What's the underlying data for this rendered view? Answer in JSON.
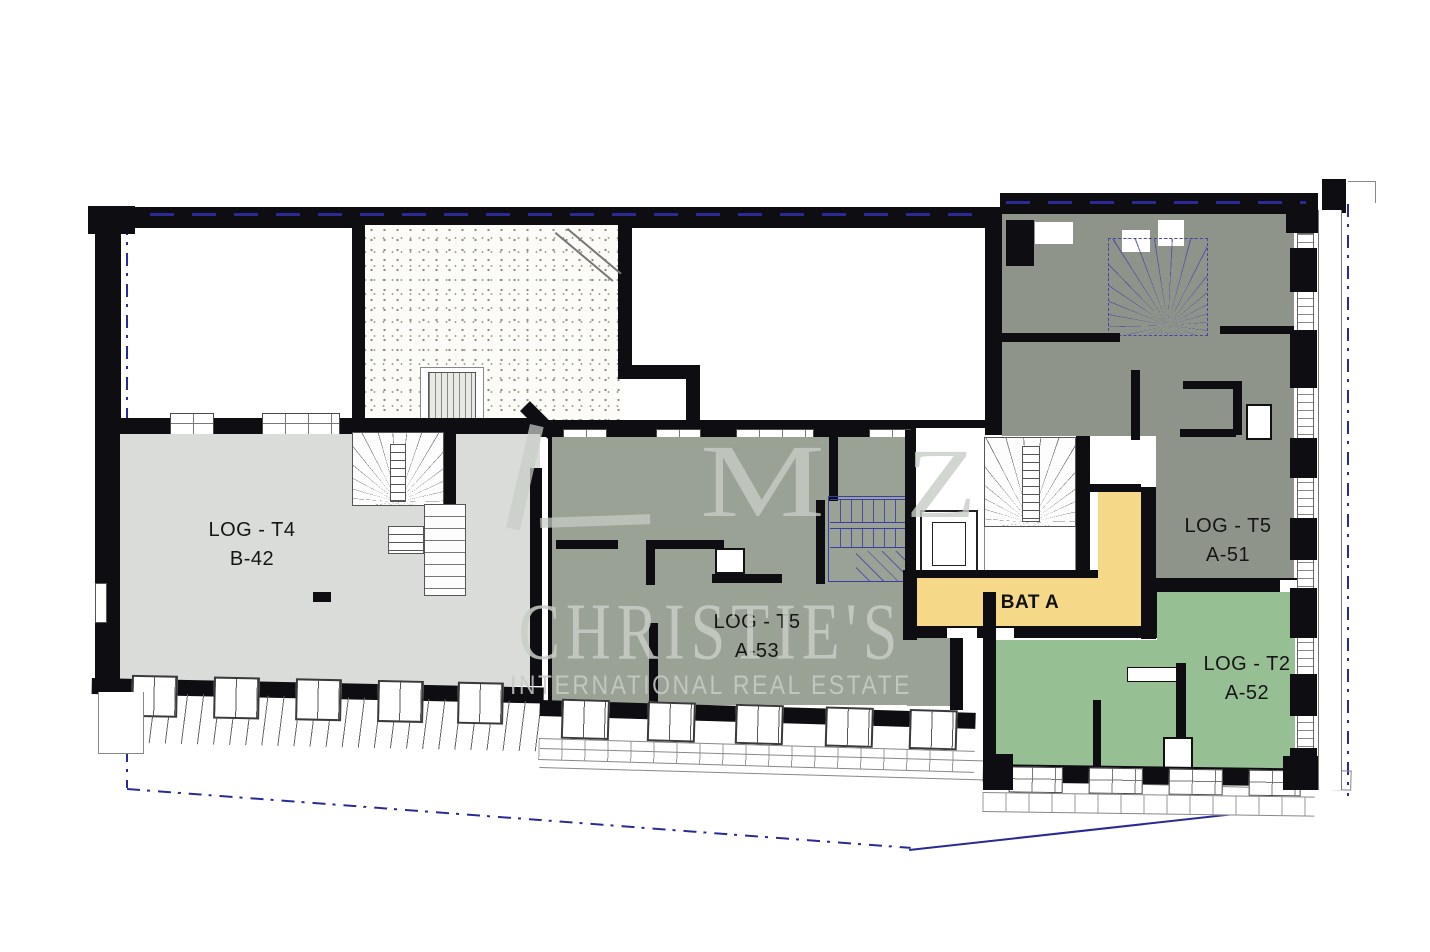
{
  "units": [
    {
      "label": "LOG - T4",
      "code": "B-42"
    },
    {
      "label": "LOG - T5",
      "code": "A-53"
    },
    {
      "label": "LOG - T5",
      "code": "A-51"
    },
    {
      "label": "LOG - T2",
      "code": "A-52"
    }
  ],
  "core": {
    "label": "BAT A"
  },
  "watermark": {
    "logo_m": "M",
    "logo_z": "Z",
    "brand": "CHRISTIE'S",
    "tagline": "INTERNATIONAL REAL ESTATE"
  },
  "colors": {
    "walls": "#0d0d12",
    "boundary": "#2a2a96",
    "watermark": "#c8cdc6",
    "unit_b42": "#d9dcd8",
    "unit_a53": "#99a294",
    "unit_a51": "#8e948a",
    "unit_a52": "#97bf94",
    "core_bat_a": "#f6d988",
    "stair_blue": "#4646a8"
  }
}
